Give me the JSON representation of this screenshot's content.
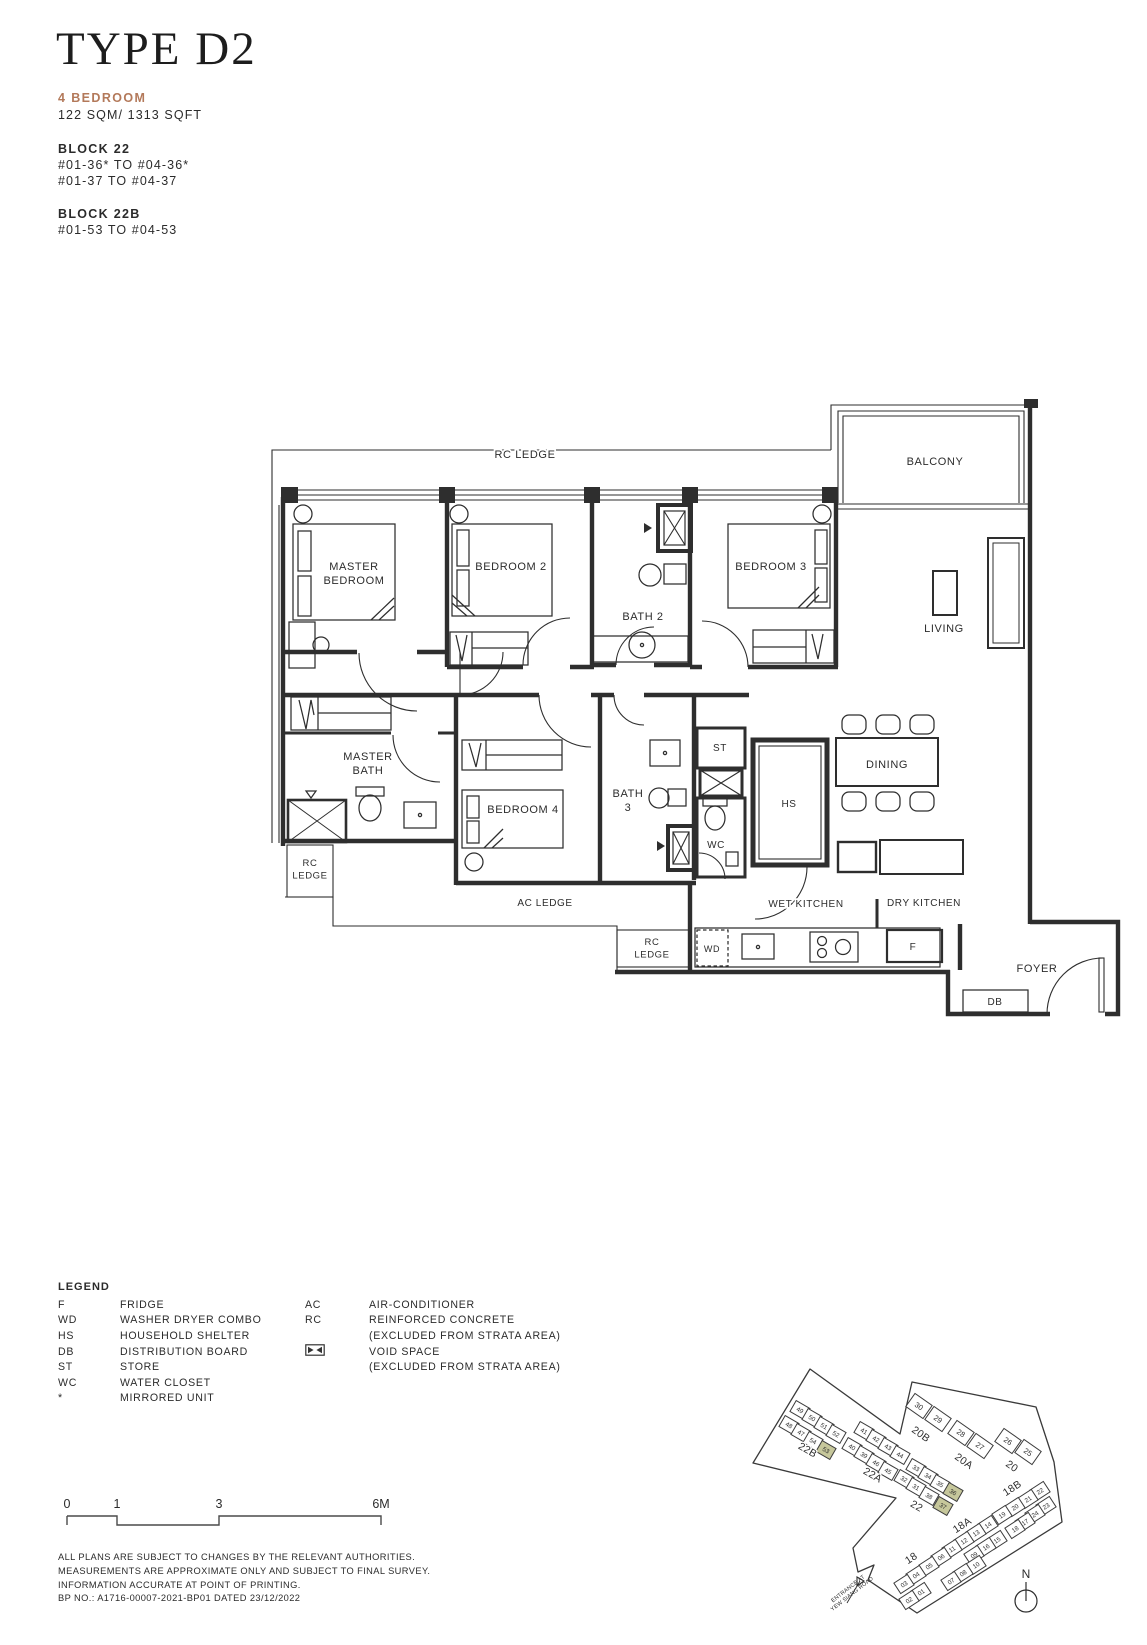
{
  "header": {
    "title": "TYPE D2",
    "unit_type": "4 BEDROOM",
    "area": "122 SQM/ 1313 SQFT",
    "accent_color": "#b3795a",
    "blocks": [
      {
        "name": "BLOCK 22",
        "stacks": [
          "#01-36* TO #04-36*",
          "#01-37 TO #04-37"
        ]
      },
      {
        "name": "BLOCK 22B",
        "stacks": [
          "#01-53 TO #04-53"
        ]
      }
    ]
  },
  "floor_plan": {
    "labels": [
      {
        "t": [
          "RC LEDGE"
        ],
        "x": 525,
        "y": 458
      },
      {
        "t": [
          "BALCONY"
        ],
        "x": 935,
        "y": 465
      },
      {
        "t": [
          "MASTER",
          "BEDROOM"
        ],
        "x": 354,
        "y": 570
      },
      {
        "t": [
          "BEDROOM 2"
        ],
        "x": 511,
        "y": 570
      },
      {
        "t": [
          "BATH 2"
        ],
        "x": 643,
        "y": 620
      },
      {
        "t": [
          "BEDROOM 3"
        ],
        "x": 771,
        "y": 570
      },
      {
        "t": [
          "LIVING"
        ],
        "x": 944,
        "y": 632
      },
      {
        "t": [
          "MASTER",
          "BATH"
        ],
        "x": 368,
        "y": 760
      },
      {
        "t": [
          "BEDROOM 4"
        ],
        "x": 523,
        "y": 813
      },
      {
        "t": [
          "BATH",
          "3"
        ],
        "x": 628,
        "y": 797
      },
      {
        "t": [
          "ST"
        ],
        "x": 720,
        "y": 751,
        "fs": 10
      },
      {
        "t": [
          "WC"
        ],
        "x": 716,
        "y": 848,
        "fs": 10
      },
      {
        "t": [
          "HS"
        ],
        "x": 789,
        "y": 807,
        "fs": 10
      },
      {
        "t": [
          "DINING"
        ],
        "x": 887,
        "y": 768
      },
      {
        "t": [
          "RC",
          "LEDGE"
        ],
        "x": 310,
        "y": 866,
        "fs": 9.5
      },
      {
        "t": [
          "AC LEDGE"
        ],
        "x": 545,
        "y": 906,
        "fs": 10
      },
      {
        "t": [
          "RC",
          "LEDGE"
        ],
        "x": 652,
        "y": 945,
        "fs": 9.5
      },
      {
        "t": [
          "WD"
        ],
        "x": 712,
        "y": 952,
        "fs": 9
      },
      {
        "t": [
          "WET KITCHEN"
        ],
        "x": 806,
        "y": 907,
        "fs": 10
      },
      {
        "t": [
          "DRY KITCHEN"
        ],
        "x": 924,
        "y": 906,
        "fs": 10
      },
      {
        "t": [
          "F"
        ],
        "x": 913,
        "y": 950,
        "fs": 10
      },
      {
        "t": [
          "DB"
        ],
        "x": 995,
        "y": 1005,
        "fs": 10
      },
      {
        "t": [
          "FOYER"
        ],
        "x": 1037,
        "y": 972
      }
    ]
  },
  "legend": {
    "heading": "LEGEND",
    "col1": [
      {
        "abbr": "F",
        "desc": "FRIDGE"
      },
      {
        "abbr": "WD",
        "desc": "WASHER DRYER COMBO"
      },
      {
        "abbr": "HS",
        "desc": "HOUSEHOLD SHELTER"
      },
      {
        "abbr": "DB",
        "desc": "DISTRIBUTION BOARD"
      },
      {
        "abbr": "ST",
        "desc": "STORE"
      },
      {
        "abbr": "WC",
        "desc": "WATER CLOSET"
      },
      {
        "abbr": "*",
        "desc": "MIRRORED UNIT"
      }
    ],
    "col2": [
      {
        "abbr": "AC",
        "desc": "AIR-CONDITIONER"
      },
      {
        "abbr": "RC",
        "desc": "REINFORCED CONCRETE"
      },
      {
        "abbr": "",
        "desc": "(EXCLUDED FROM STRATA AREA)"
      },
      {
        "abbr": "",
        "icon": "void-space-icon",
        "desc": "VOID SPACE"
      },
      {
        "abbr": "",
        "desc": "(EXCLUDED FROM STRATA AREA)"
      }
    ]
  },
  "scale_bar": {
    "ticks": [
      "0",
      "1",
      "3",
      "6M"
    ]
  },
  "disclaimer": [
    "ALL PLANS ARE SUBJECT TO CHANGES BY THE RELEVANT AUTHORITIES.",
    "MEASUREMENTS ARE APPROXIMATE ONLY AND SUBJECT TO FINAL SURVEY.",
    "INFORMATION ACCURATE AT POINT OF PRINTING.",
    "BP NO.: A1716-00007-2021-BP01 DATED 23/12/2022"
  ],
  "site_map": {
    "highlight_color": "#c6c79b",
    "north_label": "N",
    "entrance_label": [
      "ENTRANCE AT",
      "YEW SIANG ROAD"
    ],
    "blocks": [
      {
        "n": "22B",
        "x": 806,
        "y": 1453,
        "r": 30
      },
      {
        "n": "22A",
        "x": 871,
        "y": 1478,
        "r": 30
      },
      {
        "n": "22",
        "x": 915,
        "y": 1509,
        "r": 30
      },
      {
        "n": "20B",
        "x": 919,
        "y": 1437,
        "r": 35
      },
      {
        "n": "20A",
        "x": 962,
        "y": 1464,
        "r": 35
      },
      {
        "n": "20",
        "x": 1010,
        "y": 1469,
        "r": 35
      },
      {
        "n": "18B",
        "x": 1014,
        "y": 1491,
        "r": -33
      },
      {
        "n": "18A",
        "x": 964,
        "y": 1528,
        "r": -33
      },
      {
        "n": "18",
        "x": 913,
        "y": 1561,
        "r": -33
      }
    ],
    "units": [
      {
        "n": "49",
        "x": 800,
        "y": 1410,
        "r": 30
      },
      {
        "n": "50",
        "x": 812,
        "y": 1418,
        "r": 30
      },
      {
        "n": "51",
        "x": 824,
        "y": 1426,
        "r": 30
      },
      {
        "n": "52",
        "x": 836,
        "y": 1434,
        "r": 30
      },
      {
        "n": "48",
        "x": 789,
        "y": 1425,
        "r": 30
      },
      {
        "n": "47",
        "x": 801,
        "y": 1433,
        "r": 30
      },
      {
        "n": "54",
        "x": 813,
        "y": 1441,
        "r": 30
      },
      {
        "n": "53",
        "x": 826,
        "y": 1450,
        "r": 30,
        "hl": true
      },
      {
        "n": "41",
        "x": 864,
        "y": 1431,
        "r": 30
      },
      {
        "n": "42",
        "x": 876,
        "y": 1439,
        "r": 30
      },
      {
        "n": "43",
        "x": 888,
        "y": 1447,
        "r": 30
      },
      {
        "n": "44",
        "x": 900,
        "y": 1455,
        "r": 30
      },
      {
        "n": "40",
        "x": 852,
        "y": 1447,
        "r": 30
      },
      {
        "n": "39",
        "x": 864,
        "y": 1455,
        "r": 30
      },
      {
        "n": "46",
        "x": 876,
        "y": 1463,
        "r": 30
      },
      {
        "n": "45",
        "x": 888,
        "y": 1471,
        "r": 30
      },
      {
        "n": "33",
        "x": 916,
        "y": 1468,
        "r": 30
      },
      {
        "n": "34",
        "x": 928,
        "y": 1476,
        "r": 30
      },
      {
        "n": "35",
        "x": 940,
        "y": 1484,
        "r": 30
      },
      {
        "n": "36",
        "x": 953,
        "y": 1492,
        "r": 30,
        "hl": true
      },
      {
        "n": "32",
        "x": 904,
        "y": 1479,
        "r": 30
      },
      {
        "n": "31",
        "x": 916,
        "y": 1487,
        "r": 30
      },
      {
        "n": "38",
        "x": 929,
        "y": 1496,
        "r": 30
      },
      {
        "n": "37",
        "x": 943,
        "y": 1506,
        "r": 30,
        "hl": true
      },
      {
        "n": "30",
        "x": 919,
        "y": 1406,
        "r": 35,
        "big": true
      },
      {
        "n": "29",
        "x": 938,
        "y": 1419,
        "r": 35,
        "big": true
      },
      {
        "n": "28",
        "x": 961,
        "y": 1433,
        "r": 35,
        "big": true
      },
      {
        "n": "27",
        "x": 980,
        "y": 1446,
        "r": 35,
        "big": true
      },
      {
        "n": "26",
        "x": 1008,
        "y": 1441,
        "r": 35,
        "big": true
      },
      {
        "n": "25",
        "x": 1028,
        "y": 1452,
        "r": 35,
        "big": true
      },
      {
        "n": "22",
        "x": 1040,
        "y": 1491,
        "r": -33
      },
      {
        "n": "21",
        "x": 1028,
        "y": 1499,
        "r": -33
      },
      {
        "n": "20",
        "x": 1015,
        "y": 1507,
        "r": -33
      },
      {
        "n": "19",
        "x": 1002,
        "y": 1515,
        "r": -33
      },
      {
        "n": "14",
        "x": 988,
        "y": 1525,
        "r": -33
      },
      {
        "n": "13",
        "x": 976,
        "y": 1533,
        "r": -33
      },
      {
        "n": "12",
        "x": 964,
        "y": 1541,
        "r": -33
      },
      {
        "n": "11",
        "x": 952,
        "y": 1549,
        "r": -33
      },
      {
        "n": "06",
        "x": 941,
        "y": 1557,
        "r": -33
      },
      {
        "n": "05",
        "x": 929,
        "y": 1566,
        "r": -33
      },
      {
        "n": "04",
        "x": 916,
        "y": 1575,
        "r": -33
      },
      {
        "n": "03",
        "x": 904,
        "y": 1584,
        "r": -33
      },
      {
        "n": "23",
        "x": 1046,
        "y": 1506,
        "r": -33
      },
      {
        "n": "24",
        "x": 1035,
        "y": 1514,
        "r": -33
      },
      {
        "n": "17",
        "x": 1025,
        "y": 1522,
        "r": -33
      },
      {
        "n": "18",
        "x": 1015,
        "y": 1529,
        "r": -33
      },
      {
        "n": "15",
        "x": 997,
        "y": 1540,
        "r": -33
      },
      {
        "n": "16",
        "x": 986,
        "y": 1547,
        "r": -33
      },
      {
        "n": "09",
        "x": 974,
        "y": 1555,
        "r": -33
      },
      {
        "n": "10",
        "x": 976,
        "y": 1565,
        "r": -33
      },
      {
        "n": "08",
        "x": 963,
        "y": 1573,
        "r": -33
      },
      {
        "n": "07",
        "x": 951,
        "y": 1581,
        "r": -33
      },
      {
        "n": "01",
        "x": 921,
        "y": 1592,
        "r": -33
      },
      {
        "n": "02",
        "x": 909,
        "y": 1600,
        "r": -33
      }
    ]
  }
}
